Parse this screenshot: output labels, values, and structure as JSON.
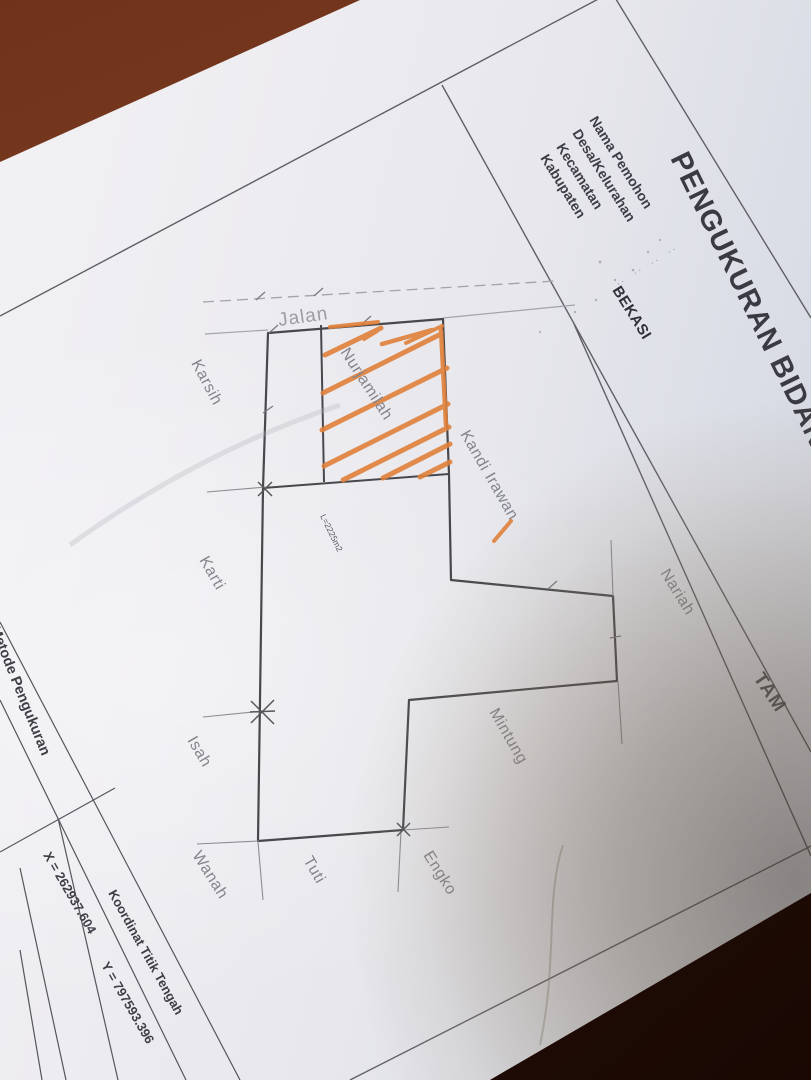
{
  "photo": {
    "surface_color": "#7a3a1f",
    "surface_shadow_color": "#230d06",
    "paper_color": "#ebeaef"
  },
  "document": {
    "title": "PENGUKURAN BIDANG",
    "corner_label": "TAM",
    "form": {
      "colon": ":",
      "fields": [
        {
          "label": "Nama Pemohon",
          "value": ""
        },
        {
          "label": "Desa/Kelurahan",
          "value": ""
        },
        {
          "label": "Kecamatan",
          "value": ""
        },
        {
          "label": "Kabupaten",
          "value": "BEKASI"
        }
      ]
    },
    "sketch": {
      "road_label": "Jalan",
      "area_label": "L=2225m2",
      "parcel_owner": "Nurjamilah",
      "hatch_color": "#e0803a",
      "neighbor_labels": [
        "Karsih",
        "Karti",
        "Isah",
        "Wanah",
        "Tuti",
        "Engko",
        "Mintung",
        "Nariah",
        "Kandi Irawan"
      ]
    },
    "footer": {
      "method_label": "Metode Pengukuran",
      "coordinates_title": "Koordinat Titik Tengah",
      "x_value": "X = 262937.604",
      "y_value": "Y = 797593.396"
    }
  }
}
